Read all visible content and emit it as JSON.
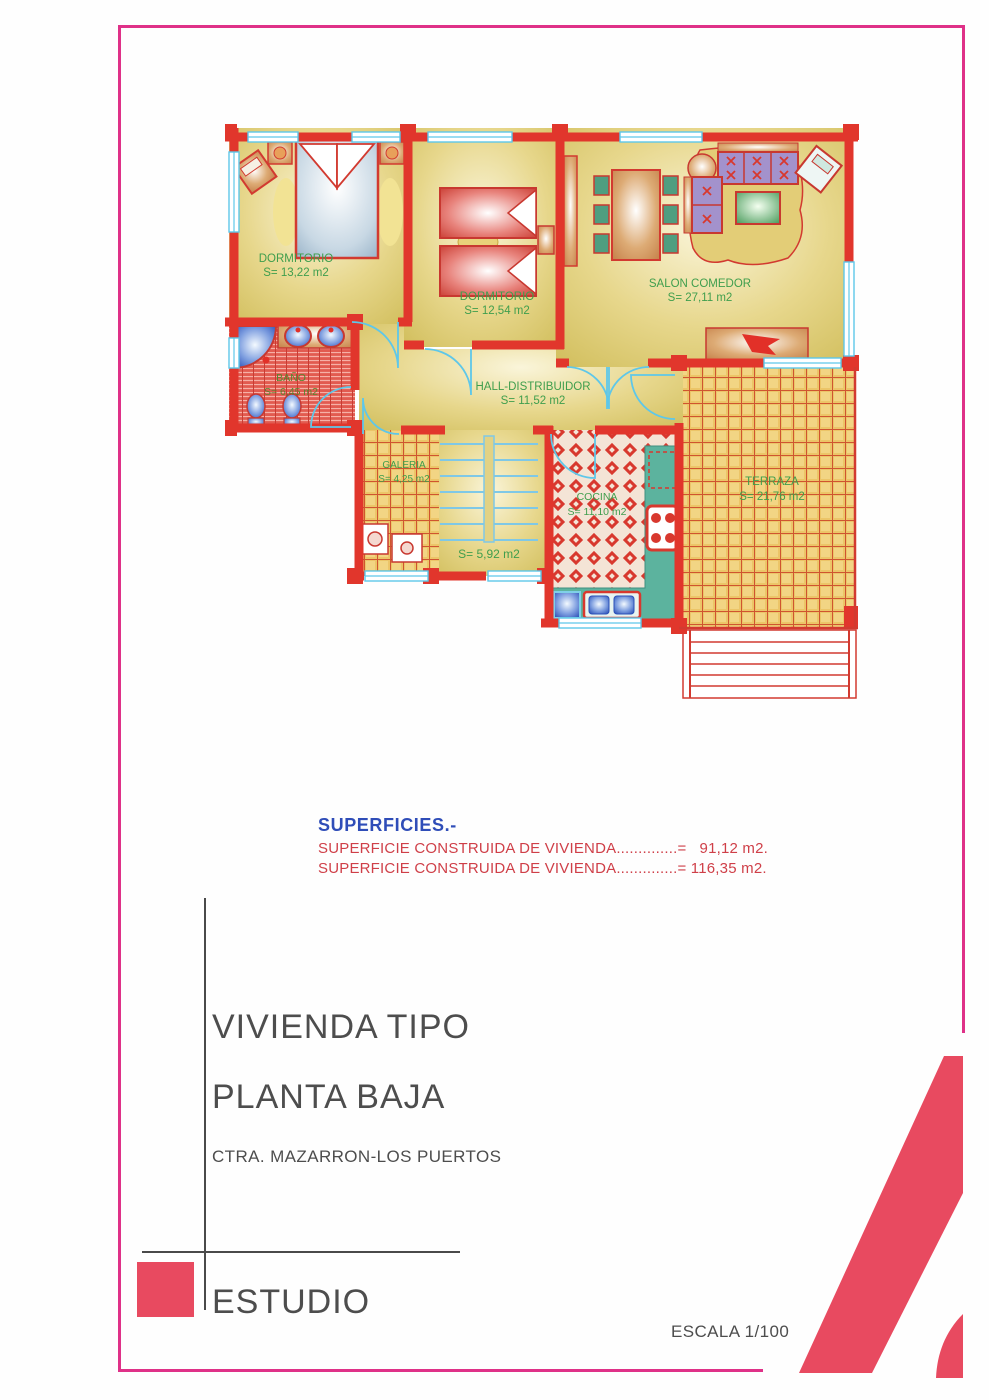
{
  "plan": {
    "rooms": {
      "dorm1": {
        "name": "DORMITORIO",
        "area": "S= 13,22 m2"
      },
      "dorm2": {
        "name": "DORMITORIO",
        "area": "S= 12,54 m2"
      },
      "salon": {
        "name": "SALON COMEDOR",
        "area": "S= 27,11 m2"
      },
      "hall": {
        "name": "HALL-DISTRIBUIDOR",
        "area": "S= 11,52 m2"
      },
      "bano": {
        "name": "BAÑO",
        "area": "S= 6,45 m2"
      },
      "galeria": {
        "name": "GALERIA",
        "area": "S= 4,25 m2"
      },
      "cocina": {
        "name": "COCINA",
        "area": "S= 11,10 m2"
      },
      "terraza": {
        "name": "TERRAZA",
        "area": "S= 21,76 m2"
      },
      "escalera": {
        "area": "S= 5,92 m2"
      }
    }
  },
  "superficies": {
    "title": "SUPERFICIES.-",
    "line1": "SUPERFICIE CONSTRUIDA DE VIVIENDA..............=   91,12 m2.",
    "line2": "SUPERFICIE CONSTRUIDA DE VIVIENDA..............= 116,35 m2."
  },
  "title_block": {
    "line1": "VIVIENDA TIPO",
    "line2": "PLANTA BAJA",
    "line3": "CTRA. MAZARRON-LOS PUERTOS",
    "studio": "ESTUDIO",
    "scale": "ESCALA 1/100"
  },
  "colors": {
    "wall_red": "#e1362c",
    "window_cyan": "#5ec7e9",
    "floor_khaki": "#e0d07a",
    "label_green": "#3f9e4d",
    "frame_magenta": "#df3188",
    "logo_pink": "#e84a60",
    "superficies_blue": "#2f4db8",
    "superficies_red": "#cf3f48",
    "title_gray": "#4d4d4d"
  }
}
